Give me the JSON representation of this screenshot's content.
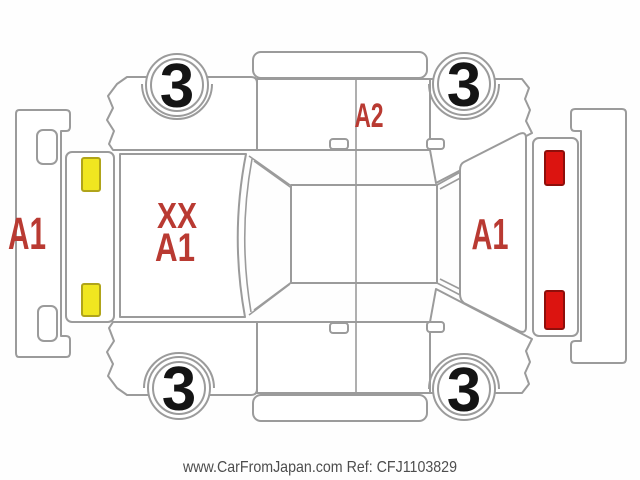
{
  "diagram": {
    "kind": "vehicle-inspection-damage-diagram",
    "watermark": "www.CarFromJapan.com Ref: CFJ1103829",
    "damage_labels": {
      "front_bumper": "A1",
      "hood_line1": "XX",
      "hood_line2": "A1",
      "side_panel": "A2",
      "rear_gate": "A1"
    },
    "wheel_grades": {
      "top_left": "3",
      "top_right": "3",
      "bottom_left": "3",
      "bottom_right": "3"
    },
    "colors": {
      "damage_label_red": "#b93a32",
      "headlight_yellow": "#f0e620",
      "headlight_border": "#b0a41a",
      "taillight_red": "#dc1410",
      "taillight_border": "#8f0f0b",
      "line_gray": "#9b9b9b",
      "watermark_gray": "#4d4d4d"
    }
  }
}
